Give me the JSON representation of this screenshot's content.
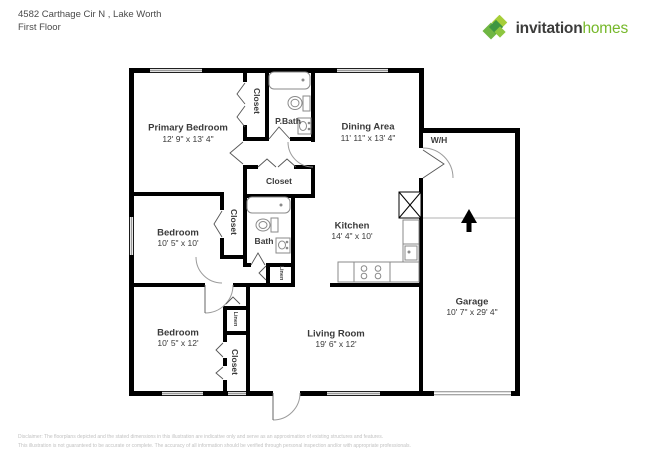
{
  "header": {
    "address": "4582 Carthage Cir N , Lake Worth",
    "floor": "First Floor"
  },
  "logo": {
    "brand_bold": "invitation",
    "brand_light": "homes",
    "icon": "leaf-diamonds-icon",
    "colors": {
      "dark_text": "#3c3c3b",
      "green": "#76b82a",
      "diamond_light": "#a6ce39",
      "diamond_mid": "#6fb643",
      "diamond_dark": "#3e9641"
    }
  },
  "plan": {
    "wall_color": "#000000",
    "rooms": {
      "primary": {
        "name": "Primary Bedroom",
        "dims": "12' 9\" x 13' 4\""
      },
      "dining": {
        "name": "Dining Area",
        "dims": "11' 11\" x 13' 4\""
      },
      "kitchen": {
        "name": "Kitchen",
        "dims": "14' 4\" x 10'"
      },
      "bedroom1": {
        "name": "Bedroom",
        "dims": "10' 5\" x 10'"
      },
      "bedroom2": {
        "name": "Bedroom",
        "dims": "10' 5\" x 12'"
      },
      "living": {
        "name": "Living Room",
        "dims": "19' 6\" x 12'"
      },
      "garage": {
        "name": "Garage",
        "dims": "10' 7\" x 29' 4\""
      },
      "pbath": {
        "name": "P.Bath"
      },
      "bath": {
        "name": "Bath"
      },
      "wh": {
        "name": "W/H"
      },
      "closet_primary": {
        "name": "Closet"
      },
      "closet_hall": {
        "name": "Closet"
      },
      "closet_bed1": {
        "name": "Closet"
      },
      "closet_bed2": {
        "name": "Closet"
      },
      "linen_hall": {
        "name": "Linen"
      },
      "linen_bed2": {
        "name": "Linen"
      }
    }
  },
  "footer": {
    "line1": "Disclaimer: The floorplans depicted and the stated dimensions in this illustration are indicative only and serve as an approximation of existing structures and features.",
    "line2": "This illustration is not guaranteed to be accurate or complete. The accuracy of all information should be verified through personal inspection and/or with appropriate professionals."
  }
}
